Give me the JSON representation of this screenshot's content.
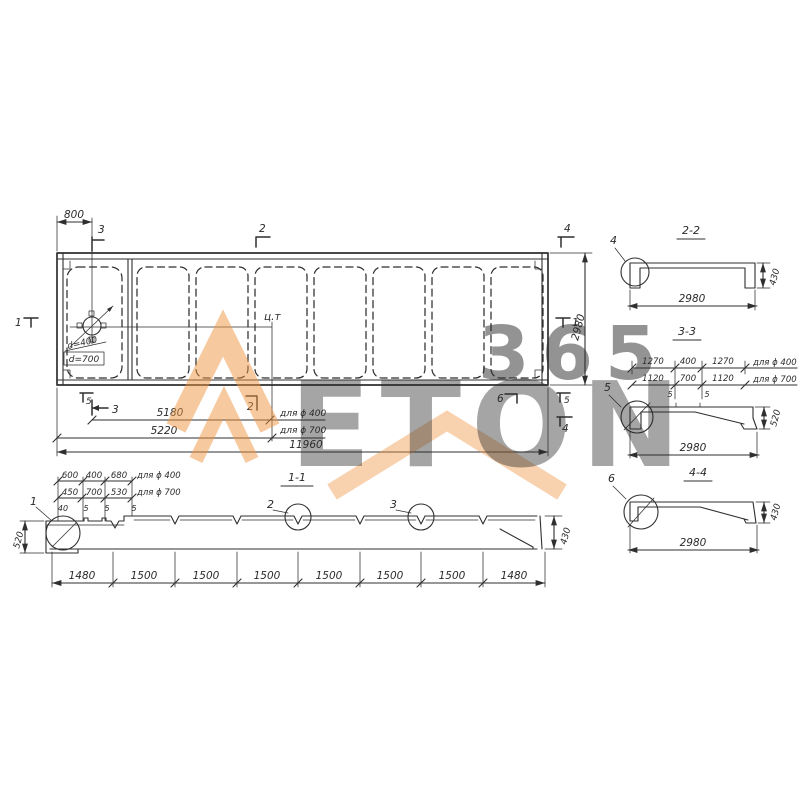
{
  "colors": {
    "ink": "#2f2f2f",
    "paper": "#ffffff",
    "watermark_orange": "#ef9440",
    "watermark_gray": "#c9c9c9"
  },
  "watermark": {
    "word": "ETON",
    "number": "365"
  },
  "plan": {
    "dim_top": "800",
    "dim_right": "2980",
    "dim_cg_400": "5180",
    "dim_cg_400_suffix": "для ϕ 400",
    "dim_cg_700": "5220",
    "dim_cg_700_suffix": "для ϕ 700",
    "dim_total": "11960",
    "hole_d400": "d=400",
    "hole_d700": "d=700",
    "cg_label": "ц.т",
    "mark_top_3": "3",
    "mark_top_2": "2",
    "mark_top_4": "4",
    "mark_left_1": "1",
    "mark_right_1": "1",
    "mark_bottom_5_left": "5",
    "mark_bottom_3": "3",
    "mark_bottom_2": "2",
    "mark_bottom_6": "6",
    "mark_bottom_5_right": "5",
    "mark_bottom_4": "4"
  },
  "section11": {
    "title": "1-1",
    "dims_400": [
      "600",
      "400",
      "680"
    ],
    "dims_400_suffix": "для ϕ 400",
    "dims_700": [
      "450",
      "700",
      "530"
    ],
    "dims_700_suffix": "для ϕ 700",
    "dims_small": [
      "40",
      "5",
      "5",
      "5"
    ],
    "height_left": "520",
    "height_right": "430",
    "chain": [
      "1480",
      "1500",
      "1500",
      "1500",
      "1500",
      "1500",
      "1500",
      "1480"
    ],
    "detail_1": "1",
    "detail_2": "2",
    "detail_3": "3"
  },
  "section22": {
    "title": "2-2",
    "detail": "4",
    "width": "2980",
    "height": "430"
  },
  "section33": {
    "title": "3-3",
    "dims_400": [
      "1270",
      "400",
      "1270"
    ],
    "dims_400_suffix": "для ϕ 400",
    "dims_700": [
      "1120",
      "700",
      "1120"
    ],
    "dims_700_suffix": "для ϕ 700",
    "dims_small": [
      "5",
      "5"
    ],
    "detail": "5",
    "width": "2980",
    "height": "520"
  },
  "section44": {
    "title": "4-4",
    "detail": "6",
    "width": "2980",
    "height": "430"
  }
}
